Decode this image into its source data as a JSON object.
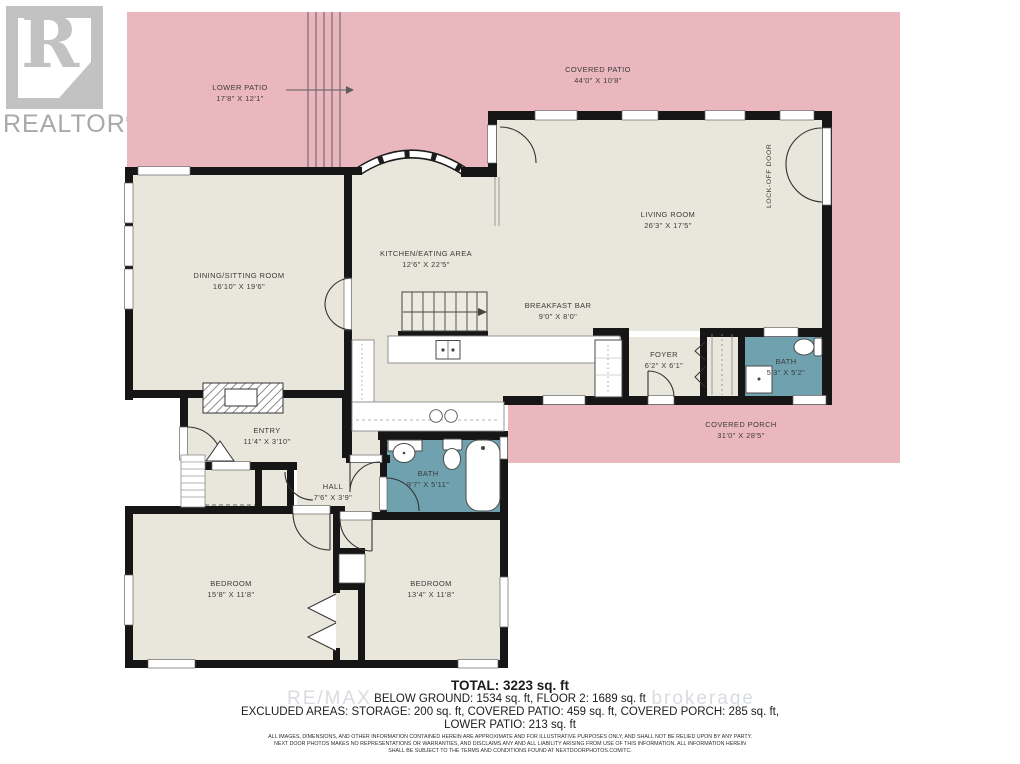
{
  "logo": {
    "letter": "R",
    "brand": "REALTOR",
    "registered": "®"
  },
  "rooms": [
    {
      "id": "lower-patio",
      "name": "LOWER PATIO",
      "dims": "17'8\" X 12'1\""
    },
    {
      "id": "covered-patio",
      "name": "COVERED PATIO",
      "dims": "44'0\" X 10'8\""
    },
    {
      "id": "living-room",
      "name": "LIVING ROOM",
      "dims": "26'3\" X 17'5\""
    },
    {
      "id": "dining-sitting",
      "name": "DINING/SITTING ROOM",
      "dims": "16'10\" X 19'6\""
    },
    {
      "id": "kitchen-eating",
      "name": "KITCHEN/EATING AREA",
      "dims": "12'6\" X 22'5\""
    },
    {
      "id": "breakfast-bar",
      "name": "BREAKFAST BAR",
      "dims": "9'0\" X 8'0\""
    },
    {
      "id": "foyer",
      "name": "FOYER",
      "dims": "6'2\" X 6'1\""
    },
    {
      "id": "bath-small",
      "name": "BATH",
      "dims": "5'3\" X 5'2\""
    },
    {
      "id": "covered-porch",
      "name": "COVERED PORCH",
      "dims": "31'0\" X 28'5\""
    },
    {
      "id": "entry",
      "name": "ENTRY",
      "dims": "11'4\" X 3'10\""
    },
    {
      "id": "hall",
      "name": "HALL",
      "dims": "7'6\" X 3'9\""
    },
    {
      "id": "bath-main",
      "name": "BATH",
      "dims": "9'7\" X 5'11\""
    },
    {
      "id": "bedroom-left",
      "name": "BEDROOM",
      "dims": "15'8\" X 11'8\""
    },
    {
      "id": "bedroom-right",
      "name": "BEDROOM",
      "dims": "13'4\" X 11'8\""
    }
  ],
  "annotations": {
    "lock_off_door": "LOCK-OFF DOOR"
  },
  "watermark": {
    "left": "RE/MAX",
    "right": "brokerage"
  },
  "summary": {
    "total": "TOTAL: 3223 sq. ft",
    "line2": "BELOW GROUND: 1534 sq. ft, FLOOR 2: 1689 sq. ft",
    "line3": "EXCLUDED AREAS: STORAGE: 200 sq. ft, COVERED PATIO: 459 sq. ft, COVERED PORCH: 285 sq. ft,",
    "line4": "LOWER PATIO: 213 sq. ft"
  },
  "disclaimer": {
    "line1": "ALL IMAGES, DIMENSIONS, AND OTHER INFORMATION CONTAINED HEREIN ARE APPROXIMATE AND FOR ILLUSTRATIVE PURPOSES ONLY, AND SHALL NOT BE RELIED UPON BY ANY PARTY.",
    "line2": "NEXT DOOR PHOTOS MAKES NO REPRESENTATIONS OR WARRANTIES, AND DISCLAIMS ANY AND ALL LIABILITY ARISING FROM USE OF THIS INFORMATION. ALL INFORMATION HEREIN",
    "line3": "SHALL BE SUBJECT TO THE TERMS AND CONDITIONS FOUND AT NEXTDOORPHOTOS.COM/TC."
  },
  "colors": {
    "patio_pink": "#EBB7BF",
    "floor_cream": "#E9E6DB",
    "bath_teal": "#6FA1AF",
    "wall_black": "#161616"
  }
}
